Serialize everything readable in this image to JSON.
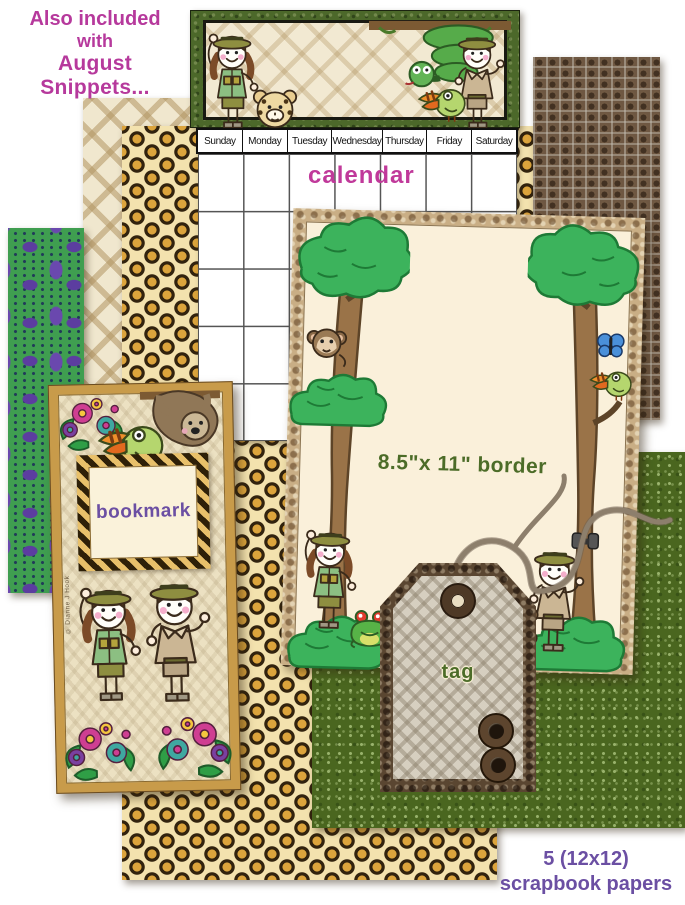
{
  "header": {
    "line1": "Also included",
    "line2": "with",
    "line3": "August Snippets..."
  },
  "calendar": {
    "label": "calendar",
    "days": [
      "Sunday",
      "Monday",
      "Tuesday",
      "Wednesday",
      "Thursday",
      "Friday",
      "Saturday"
    ]
  },
  "border_page": {
    "label": "8.5\"x 11\" border"
  },
  "bookmark": {
    "label": "bookmark",
    "credit": "© Dianne J Hook"
  },
  "tag": {
    "label": "tag"
  },
  "footer": {
    "line1": "5 (12x12)",
    "line2": "scrapbook papers"
  },
  "papers": {
    "patterns": [
      "tan diamond",
      "leopard print",
      "crocodile skin",
      "green speckle",
      "purple-green animal print"
    ]
  },
  "colors": {
    "magenta_text": "#b6399c",
    "purple_text": "#6b4fa3",
    "green_text": "#4c6c28",
    "leopard_base": "#f3e2ae",
    "leopard_spot": "#dca43c",
    "croc_brown": "#6e5742",
    "green_paper": "#4a661f",
    "purple_paper_green": "#3f9e50",
    "purple_paper_purple": "#5c3da0",
    "tan_diamond": "#c9b188",
    "gold_frame": "#c89b4a",
    "page_cream": "#faf0da"
  }
}
